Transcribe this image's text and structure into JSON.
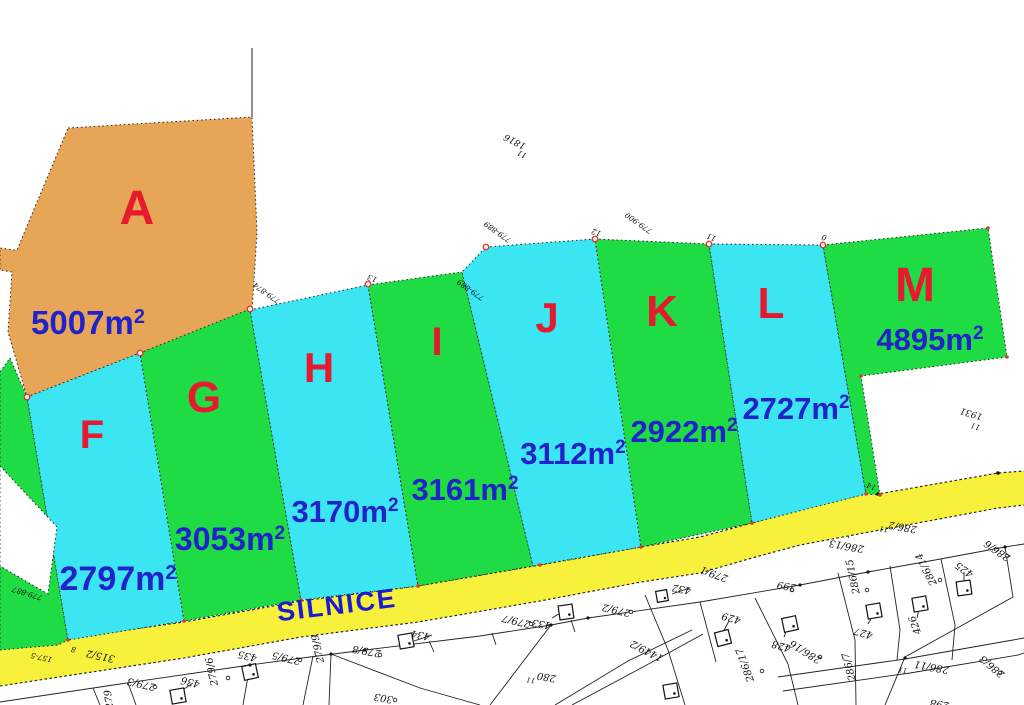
{
  "map": {
    "road_label": "SILNICE",
    "unit": "m",
    "unit_sup": "2",
    "colors": {
      "plot_orange": "#E7A557",
      "plot_green": "#1FDC45",
      "plot_cyan": "#3BE5F2",
      "road_yellow": "#F8F13B",
      "letter_red": "#E6192E",
      "label_blue": "#2222CB"
    },
    "plots": [
      {
        "letter": "A",
        "area": "5007"
      },
      {
        "letter": "F",
        "area": "2797"
      },
      {
        "letter": "G",
        "area": "3053"
      },
      {
        "letter": "H",
        "area": "3170"
      },
      {
        "letter": "I",
        "area": "3161"
      },
      {
        "letter": "J",
        "area": "3112"
      },
      {
        "letter": "K",
        "area": "2922"
      },
      {
        "letter": "L",
        "area": "2727"
      },
      {
        "letter": "M",
        "area": "4895"
      }
    ],
    "survey_marks": [
      "1816",
      "11",
      "779-889",
      "779-889",
      "12",
      "779-900",
      "11",
      "0",
      "779-874",
      "13",
      "1931",
      "11",
      "779-887",
      "157-5",
      "8",
      "14"
    ],
    "cadastral_labels": [
      "315/2",
      "279",
      "435",
      "279/5",
      "279/9",
      "279/8",
      "303",
      "436",
      "279/6",
      "279/3",
      "434",
      "279/7",
      "433",
      "279/2",
      "280",
      "11",
      "1449/2",
      "279/1",
      "432",
      "429",
      "428",
      "286/16",
      "286/17",
      "299",
      "286/13",
      "286/2",
      "11",
      "286/15",
      "286/14",
      "427",
      "426",
      "425",
      "286/6",
      "286/11",
      "11",
      "286/7",
      "286/3",
      "298"
    ]
  }
}
